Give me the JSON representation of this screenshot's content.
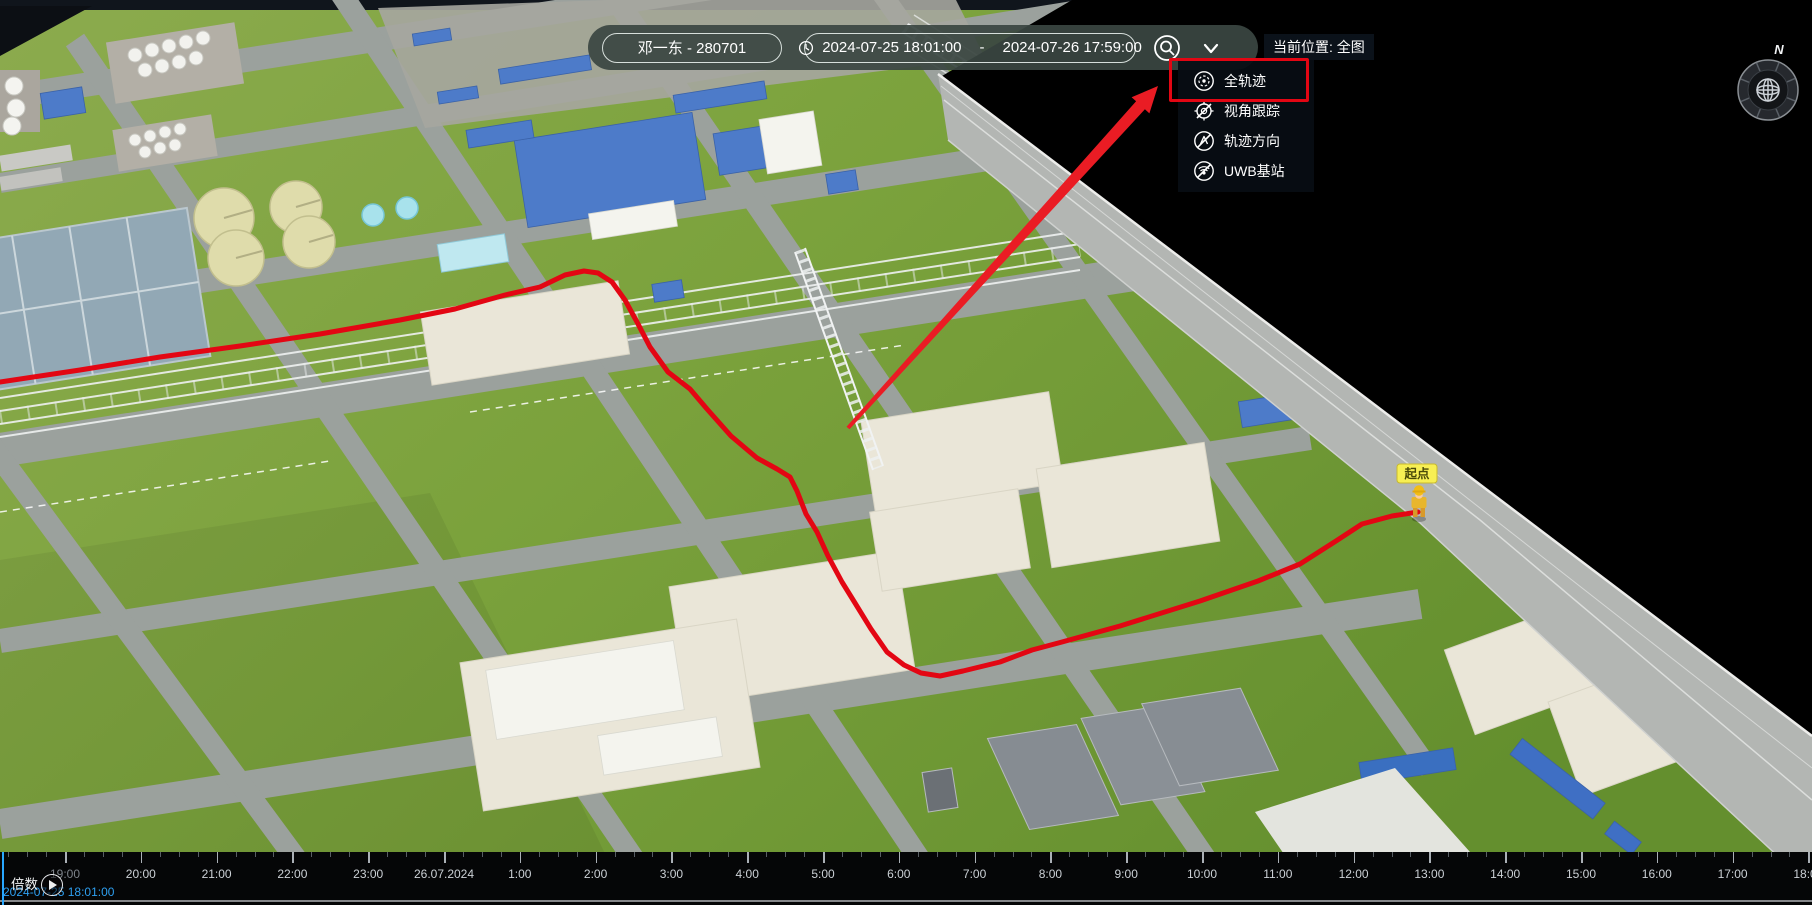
{
  "toolbar": {
    "person_selector": "邓一东 - 280701",
    "time_range": {
      "start": "2024-07-25 18:01:00",
      "separator": "-",
      "end": "2024-07-26 17:59:00"
    },
    "icons": {
      "search": "magnifier-in-circle-icon",
      "expand": "chevron-down-icon"
    }
  },
  "status": {
    "current_location_label": "当前位置: 全图"
  },
  "dropdown_menu": {
    "items": [
      {
        "label": "全轨迹",
        "icon": "full-trajectory-icon",
        "disabled": false,
        "highlighted": true
      },
      {
        "label": "视角跟踪",
        "icon": "view-tracking-icon",
        "disabled": true,
        "highlighted": false
      },
      {
        "label": "轨迹方向",
        "icon": "trajectory-direction-icon",
        "disabled": true,
        "highlighted": false
      },
      {
        "label": "UWB基站",
        "icon": "uwb-station-icon",
        "disabled": true,
        "highlighted": false
      }
    ]
  },
  "annotation": {
    "type": "red-box-and-arrow",
    "target": "全轨迹",
    "color": "#e30613"
  },
  "compass": {
    "north_label": "N"
  },
  "map": {
    "start_point_label": "起点",
    "trajectory_color": "#e30613"
  },
  "timeline": {
    "hour_labels": [
      "19:00",
      "20:00",
      "21:00",
      "22:00",
      "23:00",
      "26.07.2024",
      "1:00",
      "2:00",
      "3:00",
      "4:00",
      "5:00",
      "6:00",
      "7:00",
      "8:00",
      "9:00",
      "10:00",
      "11:00",
      "12:00",
      "13:00",
      "14:00",
      "15:00",
      "16:00",
      "17:00",
      "18:00"
    ],
    "speed_label": "倍数",
    "current_time": "2024-07-25 18:01:00",
    "playhead_color": "#28a7ff"
  }
}
